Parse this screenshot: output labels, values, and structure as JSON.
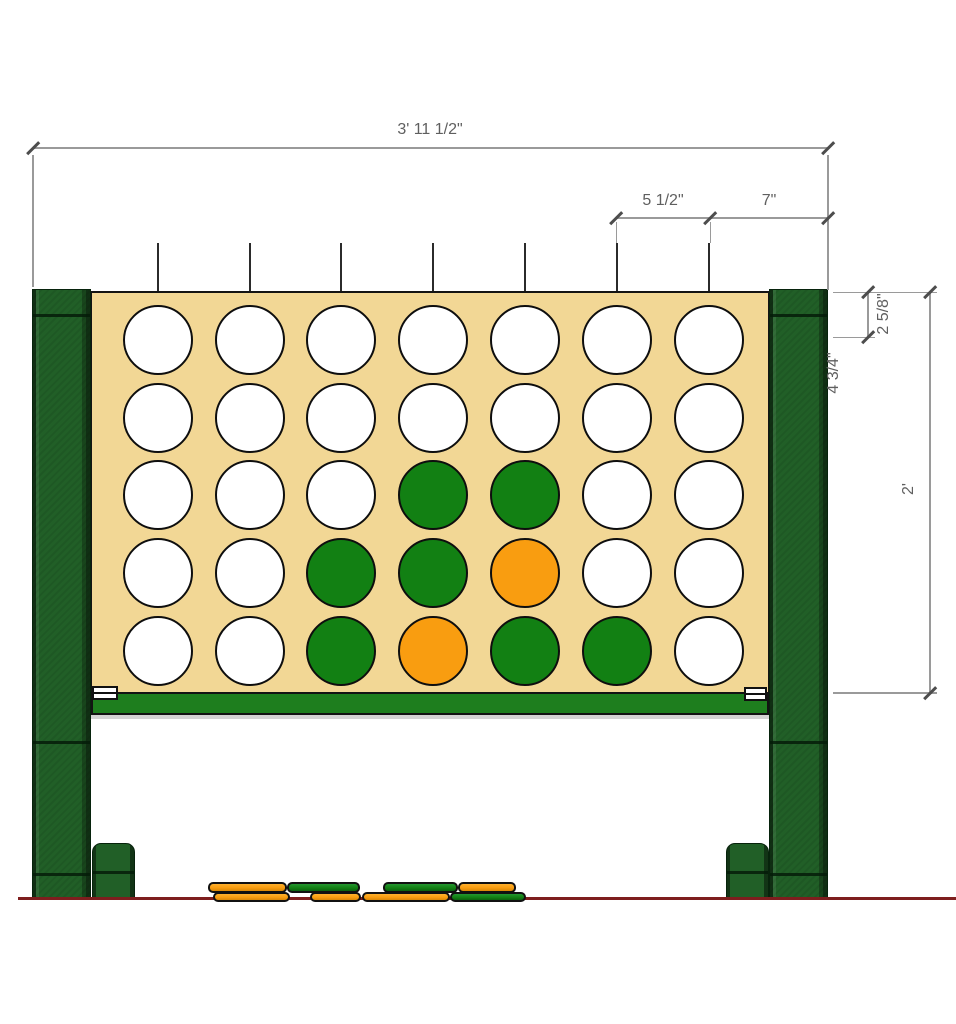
{
  "drawing": {
    "type": "front-elevation",
    "subject": "giant-connect-four-game"
  },
  "annotations": {
    "overall_width": "3' 11 1/2\"",
    "hole_spacing": "5 1/2\"",
    "side_width": "7\"",
    "top_margin": "2 5/8\"",
    "upper_offset": "4 3/4\"",
    "board_height": "2'"
  },
  "board": {
    "rows": 5,
    "cols": 7,
    "cell_legend": {
      "W": "empty-white-hole",
      "G": "green-disc",
      "O": "orange-disc"
    },
    "grid": [
      [
        "W",
        "W",
        "W",
        "W",
        "W",
        "W",
        "W"
      ],
      [
        "W",
        "W",
        "W",
        "W",
        "W",
        "W",
        "W"
      ],
      [
        "W",
        "W",
        "W",
        "G",
        "G",
        "W",
        "W"
      ],
      [
        "W",
        "W",
        "G",
        "G",
        "O",
        "W",
        "W"
      ],
      [
        "W",
        "W",
        "G",
        "O",
        "G",
        "G",
        "W"
      ]
    ]
  },
  "ground_discs": [
    {
      "layer": "top",
      "color": "orange",
      "x": 208,
      "y": 882,
      "w": 79,
      "h": 11
    },
    {
      "layer": "top",
      "color": "green",
      "x": 287,
      "y": 882,
      "w": 73,
      "h": 11
    },
    {
      "layer": "top",
      "color": "green",
      "x": 383,
      "y": 882,
      "w": 75,
      "h": 11
    },
    {
      "layer": "top",
      "color": "orange",
      "x": 458,
      "y": 882,
      "w": 58,
      "h": 11
    },
    {
      "layer": "bottom",
      "color": "orange",
      "x": 213,
      "y": 892,
      "w": 77,
      "h": 10
    },
    {
      "layer": "bottom",
      "color": "orange",
      "x": 310,
      "y": 892,
      "w": 51,
      "h": 10
    },
    {
      "layer": "bottom",
      "color": "orange",
      "x": 362,
      "y": 892,
      "w": 88,
      "h": 10
    },
    {
      "layer": "bottom",
      "color": "green",
      "x": 450,
      "y": 892,
      "w": 76,
      "h": 10
    }
  ],
  "colors": {
    "board_tan": "#F2D795",
    "disc_green": "#128013",
    "disc_orange": "#F99D10",
    "hole_white": "#FFFFFF",
    "post_green": "#215F27",
    "bar_green": "#1E7E1E",
    "ground_red": "#7E1E1E",
    "dim_line": "#9A9A9A",
    "dim_text": "#5F5F5F"
  }
}
